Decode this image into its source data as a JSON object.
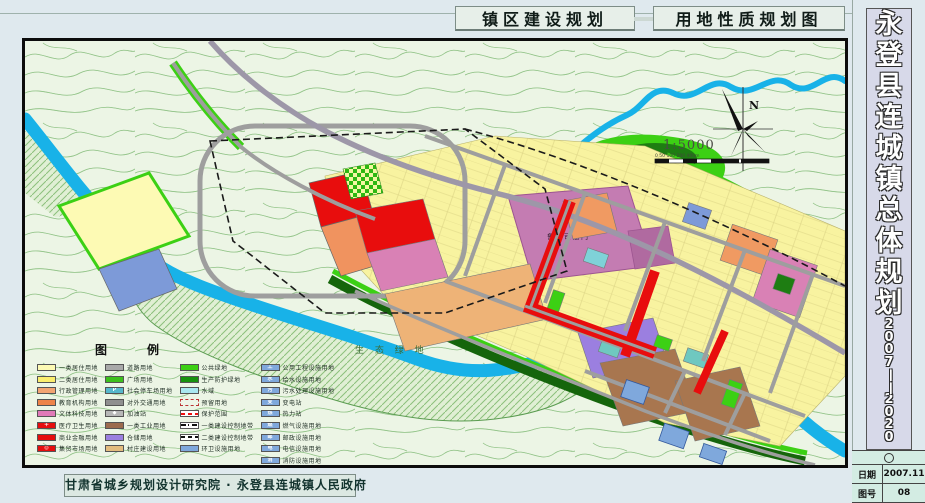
{
  "header": {
    "title_left": "镇区建设规划",
    "title_right": "用地性质规划图"
  },
  "sidebar": {
    "title_chars": [
      "永",
      "登",
      "县",
      "连",
      "城",
      "镇",
      "总",
      "体",
      "规",
      "划"
    ],
    "year_chars": [
      "2",
      "0",
      "0",
      "7",
      "—",
      "—",
      "2",
      "0",
      "2",
      "0"
    ]
  },
  "info_table": {
    "rows": [
      {
        "label": "日期",
        "value": "2007.11"
      },
      {
        "label": "图号",
        "value": "08"
      }
    ]
  },
  "footer": {
    "credit": "甘肃省城乡规划设计研究院 · 永登县连城镇人民政府"
  },
  "map": {
    "labels": {
      "historic_site": "鲁土司衙门",
      "eco_green": "生 态 绿 地"
    },
    "compass_label": "N",
    "scale_ratio": "1:5000",
    "scale_bar_labels": "0  50 100    200posits 400m",
    "scale_bar_text": "0  50 100     200           400m"
  },
  "legend": {
    "title": "图　例",
    "columns": [
      {
        "items": [
          {
            "label": "一类居住用地",
            "color": "#fdfab4"
          },
          {
            "label": "二类居住用地",
            "color": "#fbee6e"
          },
          {
            "label": "行政管理用地",
            "color": "#f2a472"
          },
          {
            "label": "教育机构用地",
            "color": "#ee8449"
          },
          {
            "label": "文体科技用地",
            "color": "#e07ab8"
          },
          {
            "label": "医疗卫生用地",
            "color": "#e60e0e",
            "symbol": "＋"
          },
          {
            "label": "商业金融用地",
            "color": "#e60e0e"
          },
          {
            "label": "集贸市场用地",
            "color": "#e60e0e",
            "symbol": "◎"
          }
        ]
      },
      {
        "items": [
          {
            "label": "道路用地",
            "color": "#a9a9a9"
          },
          {
            "label": "广场用地",
            "color": "#3cc01c"
          },
          {
            "label": "社会停车场用地",
            "color": "#56b8cc",
            "symbol": "P"
          },
          {
            "label": "对外交通用地",
            "color": "#8f8f8f"
          },
          {
            "label": "加油站",
            "color": "#b8b8b8",
            "symbol": "◆"
          },
          {
            "label": "一类工业用地",
            "color": "#9c6b4e"
          },
          {
            "label": "仓储用地",
            "color": "#9b7fe0"
          },
          {
            "label": "村庄建设用地",
            "color": "#e3bc7e"
          }
        ]
      },
      {
        "items": [
          {
            "label": "公共绿地",
            "color": "#3cd014"
          },
          {
            "label": "生产防护绿地",
            "color": "#17920e"
          },
          {
            "label": "水域",
            "color": "#aae8f0"
          },
          {
            "label": "预留用地",
            "color": "#eef6e8",
            "kind": "dashborder"
          },
          {
            "label": "保护范围",
            "color": "#ffffff",
            "kind": "reddash"
          },
          {
            "label": "一类建设控制地带",
            "color": "#ffffff",
            "kind": "dashdot"
          },
          {
            "label": "二类建设控制地带",
            "color": "#ffffff",
            "kind": "dash"
          },
          {
            "label": "环卫设施用地",
            "color": "#7fa8dc"
          }
        ]
      },
      {
        "items": [
          {
            "label": "公用工程设施用地",
            "color": "#7fa8dc",
            "symbol": "工"
          },
          {
            "label": "给水设施用地",
            "color": "#7fa8dc",
            "symbol": "水"
          },
          {
            "label": "污水处理设施用地",
            "color": "#7fa8dc",
            "symbol": "污"
          },
          {
            "label": "变电站",
            "color": "#7fa8dc",
            "symbol": "变"
          },
          {
            "label": "热力站",
            "color": "#7fa8dc",
            "symbol": "热"
          },
          {
            "label": "燃气设施用地",
            "color": "#7fa8dc",
            "symbol": "燃"
          },
          {
            "label": "邮政设施用地",
            "color": "#7fa8dc",
            "symbol": "邮"
          },
          {
            "label": "电信设施用地",
            "color": "#7fa8dc",
            "symbol": "电"
          },
          {
            "label": "消防设施用地",
            "color": "#7fa8dc",
            "symbol": "消"
          }
        ]
      }
    ]
  },
  "colors": {
    "page_bg": "#dfe9ee",
    "map_bg": "#ecf5e5",
    "contour": "#93c489",
    "river": "#18b2e8",
    "green_public": "#3cd014",
    "green_protect": "#1c7c10",
    "residential_yellow": "#f8f3a0",
    "commercial_red": "#e80d0d",
    "historic_mauve": "#c47cb2",
    "village_brown": "#a8764f",
    "warehouse_purple": "#9b7fe0",
    "utility_blue": "#7fa8dc"
  }
}
